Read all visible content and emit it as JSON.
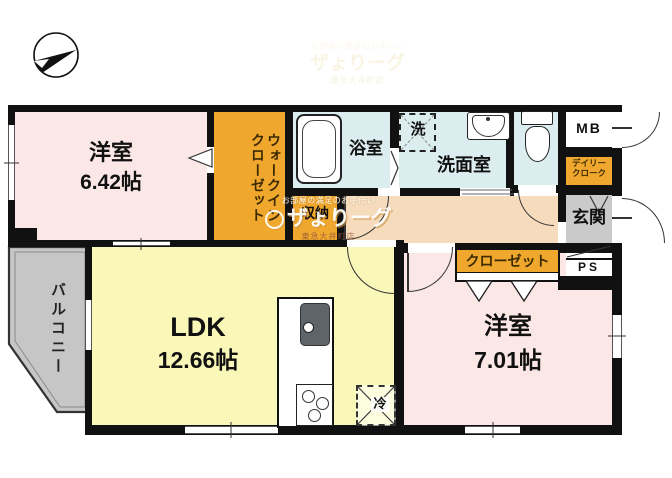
{
  "compass": {
    "label": "north-arrow"
  },
  "rooms": {
    "bedroom1": {
      "name": "洋室",
      "area": "6.42帖"
    },
    "bedroom2": {
      "name": "洋室",
      "area": "7.01帖"
    },
    "ldk": {
      "name": "LDK",
      "area": "12.66帖"
    },
    "balcony": {
      "name": "バルコニー"
    },
    "bath": {
      "name": "浴室"
    },
    "washroom": {
      "name": "洗面室"
    },
    "entrance": {
      "name": "玄関"
    }
  },
  "storage": {
    "wic_line1": "ウォークイン",
    "wic_line2": "クローゼット",
    "closet": "クローゼット",
    "shuno": "収納",
    "daily_line1": "デイリー",
    "daily_line2": "クローク"
  },
  "fixtures": {
    "washer": "洗",
    "fridge": "冷",
    "meter_box": "MB",
    "pipe_space": "PS"
  },
  "watermark": {
    "tagline": "お部屋の満足のお手伝い",
    "logo": "ザょりーグ",
    "store": "東急大井町店"
  },
  "colors": {
    "room_pink": "#fbe7e5",
    "ldk_yellow": "#f9f8b8",
    "closet_orange": "#efa72e",
    "wet_blue": "#dcedf0",
    "hall_peach": "#f6dcbc",
    "genkan_gray": "#cacaca",
    "balcony_gray": "#c6c6c6",
    "wall_black": "#111111"
  }
}
